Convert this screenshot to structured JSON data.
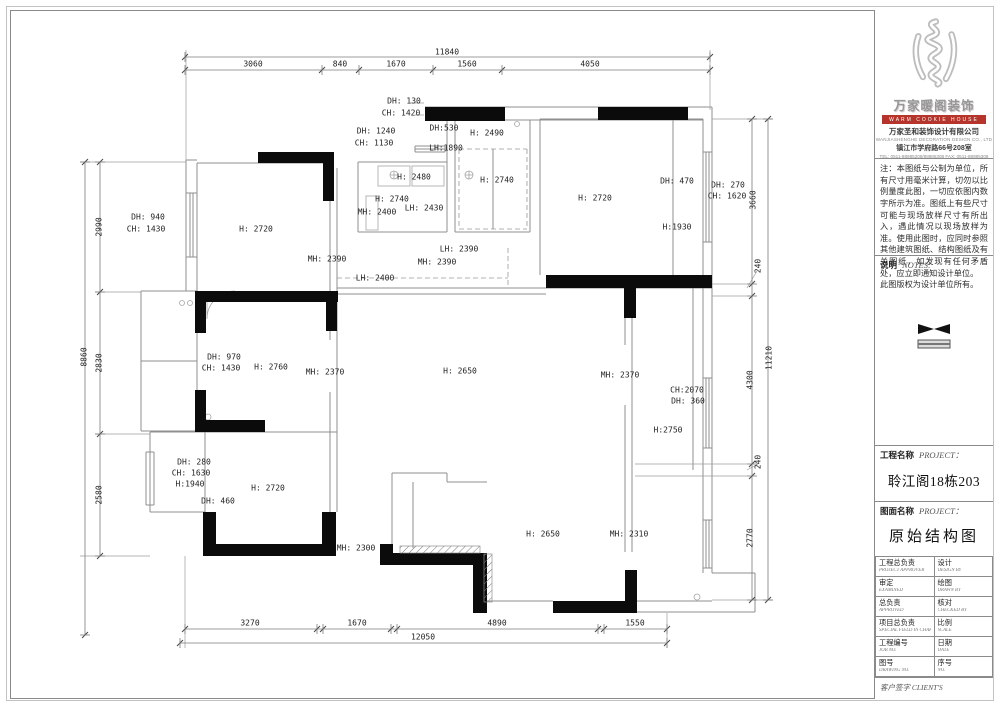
{
  "title_block": {
    "logo_title": "万家暖阁装饰",
    "logo_band": "WARM COOKIE HOUSE",
    "company_cn": "万家圣和装饰设计有限公司",
    "company_en": "WANJIASHENGHE DECORATION DESIGN CO., LTD",
    "address": "镇江市学府路66号208室",
    "tel_line": "TEL: 0511-88985208/88985308   FAX: 0511-88985308",
    "note_body": "注：本图纸与公制为单位，所有尺寸用毫米计算，切勿以比例量度此图，一切应依图内数字所示为准。图纸上有些尺寸可能与现场放样尺寸有所出入，遇此情况以现场放样为准。使用此图时，应同时参照其他建筑图纸、结构图纸及有关图纸，如发现有任何矛盾处，应立即通知设计单位。",
    "note_footer": "此图版权为设计单位所有。",
    "notes_label": "说明",
    "notes_label_en": "NOTES:",
    "project_label": "工程名称",
    "project_label_en": "PROJECT：",
    "project_name": "聆江阁18栋203",
    "drawing_label": "图面名称",
    "drawing_label_en": "PROJECT：",
    "drawing_name": "原始结构图",
    "table": [
      {
        "l1": "工程总负责",
        "l2": "PROJECT APPROVER",
        "r1": "设计",
        "r2": "DESIGN BY"
      },
      {
        "l1": "审定",
        "l2": "EXAMINED",
        "r1": "绘图",
        "r2": "DRAWN BY"
      },
      {
        "l1": "总负责",
        "l2": "APPROVED",
        "r1": "核对",
        "r2": "CHECKED BY"
      },
      {
        "l1": "项目总负责",
        "l2": "SPECIAL FIELD IN CHARGE",
        "r1": "比例",
        "r2": "SCALE"
      },
      {
        "l1": "工程编号",
        "l2": "JOB NO.",
        "r1": "日期",
        "r2": "DATE"
      },
      {
        "l1": "图号",
        "l2": "DRAWING NO.",
        "r1": "序号",
        "r2": "NO."
      }
    ],
    "client_label": "客户签字 CLIENT'S"
  },
  "plan": {
    "labels": [
      {
        "t": "11840",
        "x": 447,
        "y": 52
      },
      {
        "t": "3060",
        "x": 253,
        "y": 64
      },
      {
        "t": "840",
        "x": 340,
        "y": 64
      },
      {
        "t": "1670",
        "x": 396,
        "y": 64
      },
      {
        "t": "1560",
        "x": 467,
        "y": 64
      },
      {
        "t": "4050",
        "x": 590,
        "y": 64
      },
      {
        "t": "3270",
        "x": 250,
        "y": 623
      },
      {
        "t": "1670",
        "x": 357,
        "y": 623
      },
      {
        "t": "4890",
        "x": 497,
        "y": 623
      },
      {
        "t": "1550",
        "x": 635,
        "y": 623
      },
      {
        "t": "12050",
        "x": 423,
        "y": 637
      },
      {
        "t": "8860",
        "x": 84,
        "y": 357,
        "r": 1
      },
      {
        "t": "2990",
        "x": 99,
        "y": 227,
        "r": 1
      },
      {
        "t": "2830",
        "x": 99,
        "y": 363,
        "r": 1
      },
      {
        "t": "2580",
        "x": 99,
        "y": 495,
        "r": 1
      },
      {
        "t": "3660",
        "x": 753,
        "y": 200,
        "r": 1
      },
      {
        "t": "240",
        "x": 758,
        "y": 266,
        "r": 1
      },
      {
        "t": "4300",
        "x": 750,
        "y": 380,
        "r": 1
      },
      {
        "t": "11210",
        "x": 769,
        "y": 358,
        "r": 1
      },
      {
        "t": "240",
        "x": 758,
        "y": 462,
        "r": 1
      },
      {
        "t": "2770",
        "x": 750,
        "y": 538,
        "r": 1
      },
      {
        "t": "DH: 130",
        "x": 404,
        "y": 101
      },
      {
        "t": "CH: 1420",
        "x": 401,
        "y": 113
      },
      {
        "t": "DH: 1240",
        "x": 376,
        "y": 131
      },
      {
        "t": "CH: 1130",
        "x": 374,
        "y": 143
      },
      {
        "t": "DH:530",
        "x": 444,
        "y": 128
      },
      {
        "t": "LH:1890",
        "x": 446,
        "y": 148
      },
      {
        "t": "H: 2490",
        "x": 487,
        "y": 133
      },
      {
        "t": "H: 2740",
        "x": 497,
        "y": 180
      },
      {
        "t": "H: 2480",
        "x": 414,
        "y": 177
      },
      {
        "t": "H: 2740",
        "x": 392,
        "y": 199
      },
      {
        "t": "MH: 2400",
        "x": 377,
        "y": 212
      },
      {
        "t": "LH: 2430",
        "x": 424,
        "y": 208
      },
      {
        "t": "LH: 2390",
        "x": 459,
        "y": 249
      },
      {
        "t": "MH: 2390",
        "x": 437,
        "y": 262
      },
      {
        "t": "H: 2720",
        "x": 256,
        "y": 229
      },
      {
        "t": "MH: 2390",
        "x": 327,
        "y": 259
      },
      {
        "t": "LH: 2400",
        "x": 375,
        "y": 278
      },
      {
        "t": "H: 2720",
        "x": 595,
        "y": 198
      },
      {
        "t": "DH: 470",
        "x": 677,
        "y": 181
      },
      {
        "t": "H:1930",
        "x": 677,
        "y": 227
      },
      {
        "t": "DH: 270",
        "x": 728,
        "y": 185
      },
      {
        "t": "CH: 1620",
        "x": 727,
        "y": 196
      },
      {
        "t": "DH: 940",
        "x": 148,
        "y": 217
      },
      {
        "t": "CH: 1430",
        "x": 146,
        "y": 229
      },
      {
        "t": "DH: 970",
        "x": 224,
        "y": 357
      },
      {
        "t": "CH: 1430",
        "x": 221,
        "y": 368
      },
      {
        "t": "H: 2760",
        "x": 271,
        "y": 367
      },
      {
        "t": "MH: 2370",
        "x": 325,
        "y": 372
      },
      {
        "t": "H: 2650",
        "x": 460,
        "y": 371
      },
      {
        "t": "MH: 2370",
        "x": 620,
        "y": 375
      },
      {
        "t": "CH:2070",
        "x": 687,
        "y": 390
      },
      {
        "t": "DH: 360",
        "x": 688,
        "y": 401
      },
      {
        "t": "H:2750",
        "x": 668,
        "y": 430
      },
      {
        "t": "DH: 280",
        "x": 194,
        "y": 462
      },
      {
        "t": "CH: 1630",
        "x": 191,
        "y": 473
      },
      {
        "t": "H:1940",
        "x": 190,
        "y": 484
      },
      {
        "t": "DH: 460",
        "x": 218,
        "y": 501
      },
      {
        "t": "H: 2720",
        "x": 268,
        "y": 488
      },
      {
        "t": "MH: 2300",
        "x": 356,
        "y": 548
      },
      {
        "t": "H: 2650",
        "x": 543,
        "y": 534
      },
      {
        "t": "MH: 2310",
        "x": 629,
        "y": 534
      }
    ]
  }
}
